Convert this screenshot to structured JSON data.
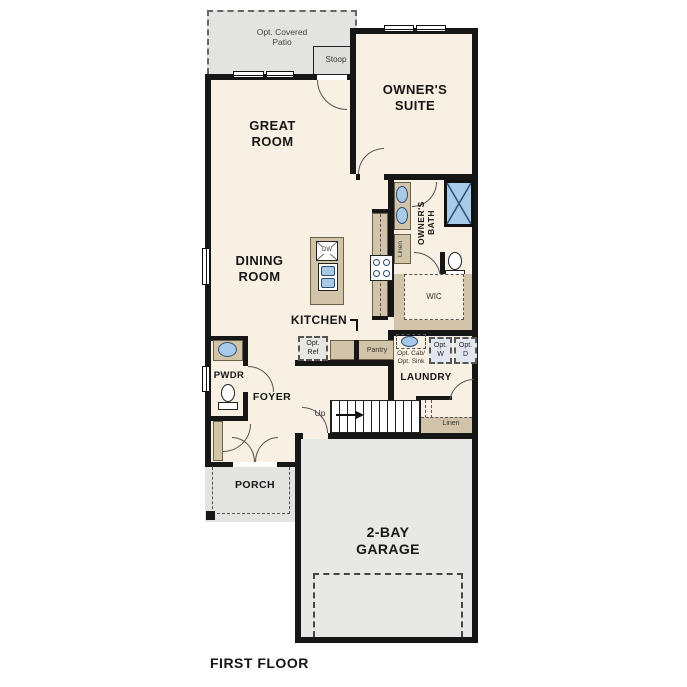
{
  "title": {
    "label": "FIRST FLOOR"
  },
  "colors": {
    "floor": "#f8f0e2",
    "outdoor_gray": "#e3e3e1",
    "cabinet_tan": "#d2c4a8",
    "fixture_blue": "#a9c9e9",
    "wall_black": "#161616",
    "optional_box": "#e2e7ef"
  },
  "rooms": {
    "patio": {
      "label": "Opt. Covered\nPatio"
    },
    "stoop": {
      "label": "Stoop"
    },
    "great_room": {
      "label": "GREAT\nROOM"
    },
    "owners_suite": {
      "label": "OWNER'S\nSUITE"
    },
    "owners_bath": {
      "label": "OWNER'S\nBATH"
    },
    "wic": {
      "label": "WIC"
    },
    "dining_room": {
      "label": "DINING\nROOM"
    },
    "kitchen": {
      "label": "KITCHEN"
    },
    "pwdr": {
      "label": "PWDR"
    },
    "foyer": {
      "label": "FOYER"
    },
    "laundry": {
      "label": "LAUNDRY"
    },
    "porch": {
      "label": "PORCH"
    },
    "garage": {
      "label": "2-BAY\nGARAGE"
    }
  },
  "fixtures": {
    "dw": "DW",
    "pantry": "Pantry",
    "opt_ref": "Opt.\nRef",
    "linen_bath": "Linen",
    "linen_hall": "Linen",
    "opt_cab_sink": "Opt. Cab/\nOpt. Sink",
    "opt_w": "Opt.\nW",
    "opt_d": "Opt.\nD",
    "up": "Up"
  }
}
